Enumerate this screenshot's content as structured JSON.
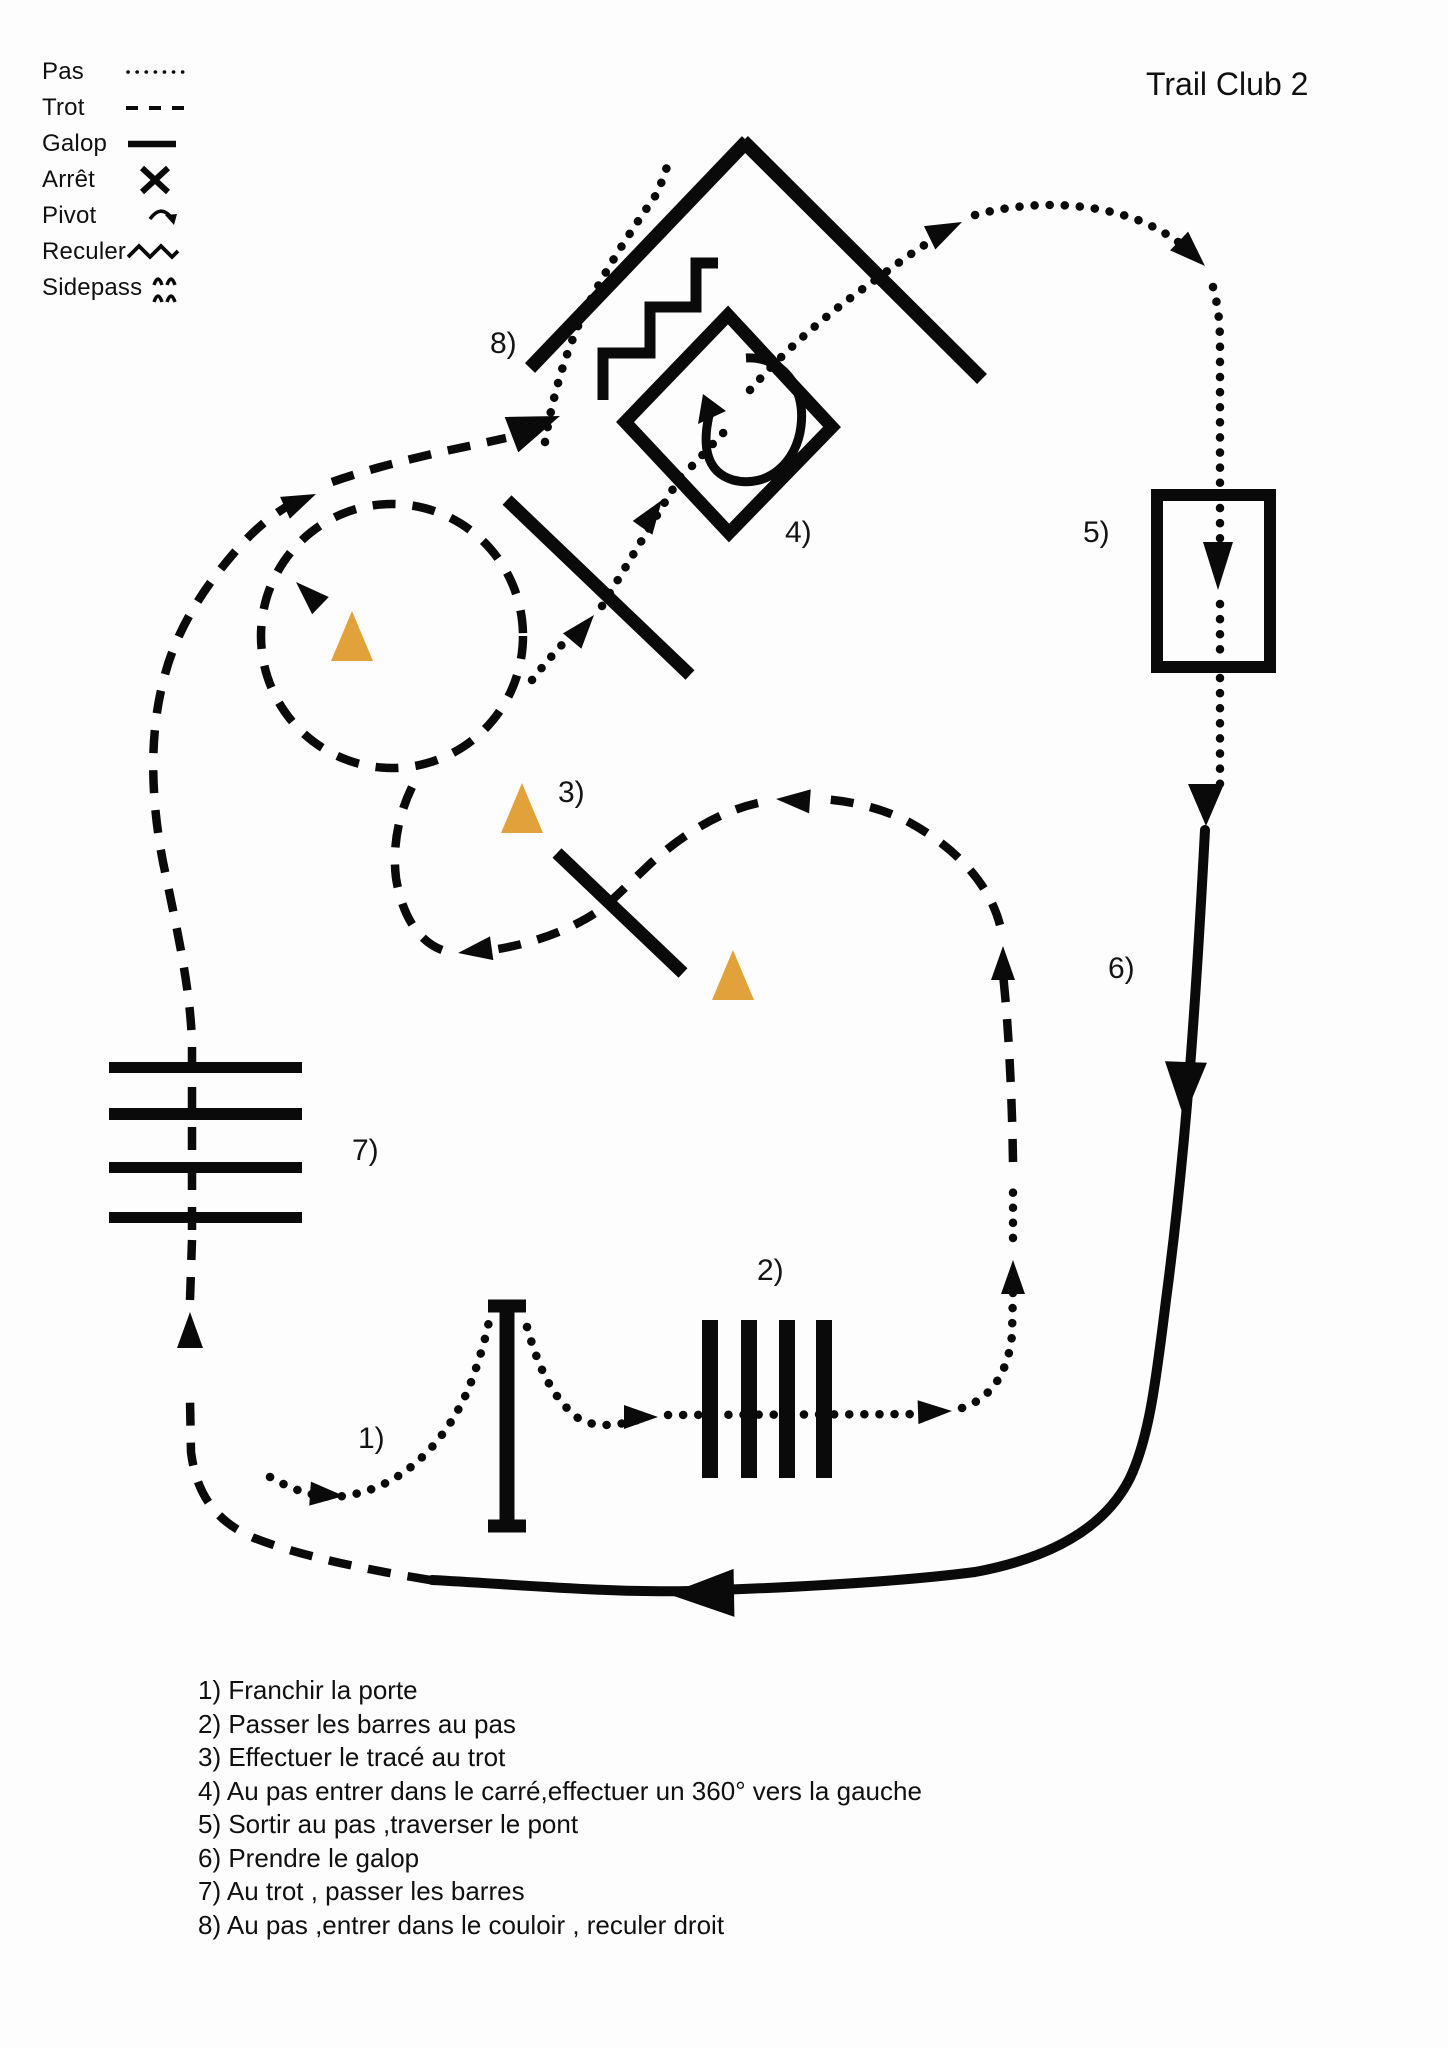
{
  "title": "Trail Club 2",
  "legend": {
    "items": [
      {
        "label": "Pas",
        "icon": "dotted-line-icon"
      },
      {
        "label": "Trot",
        "icon": "dashed-line-icon"
      },
      {
        "label": "Galop",
        "icon": "solid-line-icon"
      },
      {
        "label": "Arrêt",
        "icon": "cross-icon"
      },
      {
        "label": "Pivot",
        "icon": "pivot-curved-arrow-icon"
      },
      {
        "label": "Reculer",
        "icon": "zigzag-icon"
      },
      {
        "label": "Sidepass",
        "icon": "double-arch-icon"
      }
    ]
  },
  "course": {
    "labels": [
      {
        "id": 1,
        "text": "1)"
      },
      {
        "id": 2,
        "text": "2)"
      },
      {
        "id": 3,
        "text": "3)"
      },
      {
        "id": 4,
        "text": "4)"
      },
      {
        "id": 5,
        "text": "5)"
      },
      {
        "id": 6,
        "text": "6)"
      },
      {
        "id": 7,
        "text": "7)"
      },
      {
        "id": 8,
        "text": "8)"
      }
    ],
    "cone_color": "#e2a23b",
    "line_color": "#0a0a0a"
  },
  "instructions": [
    "1) Franchir la porte",
    "2) Passer les barres au pas",
    "3) Effectuer le tracé au trot",
    "4) Au pas entrer dans le carré,effectuer un 360° vers la gauche",
    "5) Sortir au pas ,traverser le pont",
    "6) Prendre le galop",
    "7) Au trot , passer les barres",
    "8) Au pas ,entrer dans le couloir , reculer droit"
  ]
}
